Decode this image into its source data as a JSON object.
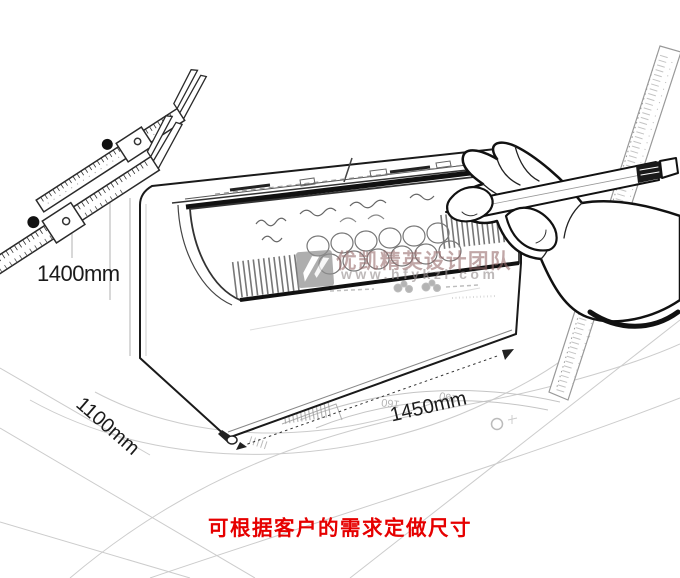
{
  "scene": {
    "caption": {
      "text": "可根据客户的需求定做尺寸",
      "color": "#e60000"
    },
    "dimension_labels": {
      "height": "1400mm",
      "depth": "1100mm",
      "width": "1450mm"
    },
    "watermark": {
      "team": "优凯精英设计团队",
      "url": "www.hfykzl.com"
    },
    "floor": {
      "protractor_label": "160"
    },
    "ink_color": "#1a1a1a",
    "floor_line_color": "#cccccc"
  }
}
